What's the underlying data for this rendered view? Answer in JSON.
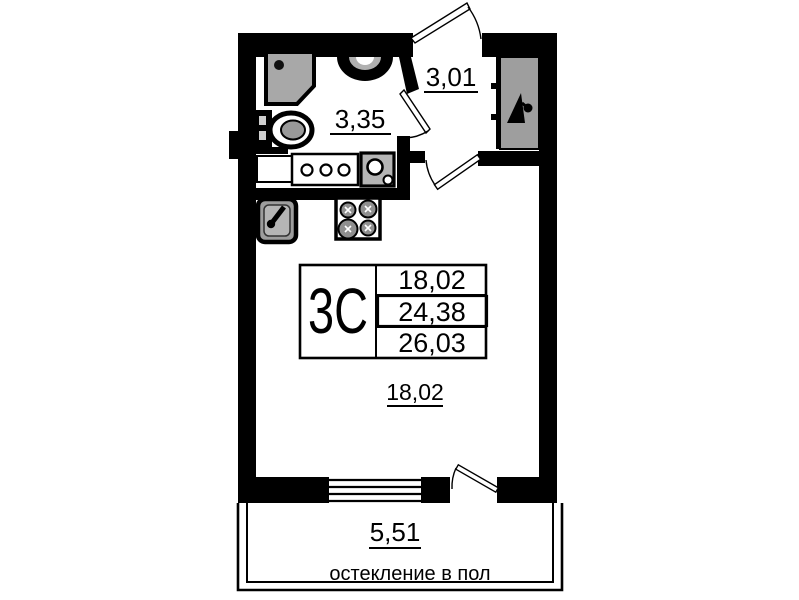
{
  "colors": {
    "wall": "#000000",
    "background": "#ffffff",
    "fixture_gray": "#a8a8a8",
    "wardrobe_gray": "#9e9e9e"
  },
  "info_table": {
    "type_label": "3C",
    "living_area": "18,02",
    "total_area": "24,38",
    "total_area_with_balcony": "26,03"
  },
  "room_labels": {
    "bathroom_area": "3,35",
    "hall_area": "3,01",
    "living_room_area": "18,02",
    "balcony_area": "5,51"
  },
  "balcony_note": "остекление в пол"
}
